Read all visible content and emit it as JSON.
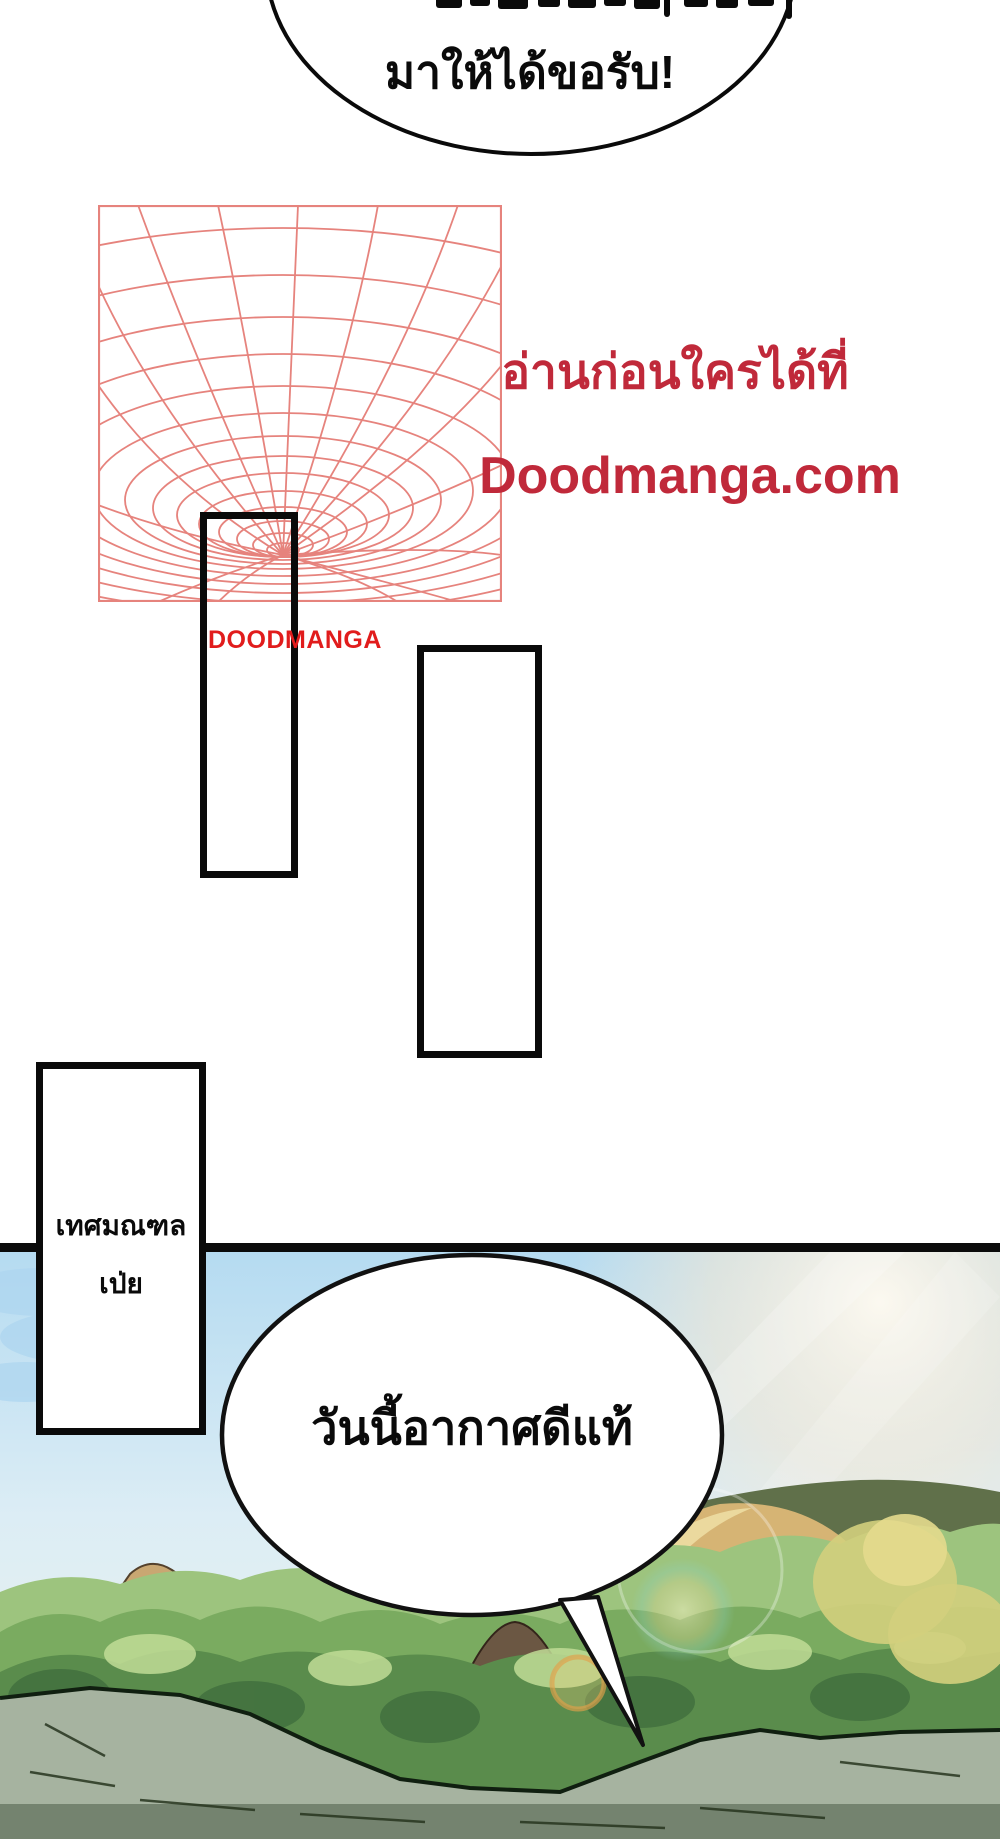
{
  "top_bubble": {
    "line": "มาให้ได้ขอรับ!"
  },
  "promo": {
    "heading": "อ่านก่อนใครได้ที่",
    "site": "Doodmanga.com",
    "watermark": "DOODMANGA",
    "heading_color": "#c0293a",
    "watermark_color": "#e11c1c"
  },
  "panels": {
    "county_line1": "เทศมณฑล",
    "county_line2": "เป่ย"
  },
  "scene_bubble": {
    "text": "วันนี้อากาศดีแท้"
  },
  "colors": {
    "spiral": "#e6837d",
    "ink": "#0a0a0a",
    "sky_blue": "#b5dbf1",
    "tree_green": "#74a55e",
    "road_gray": "#a6b3a0"
  }
}
